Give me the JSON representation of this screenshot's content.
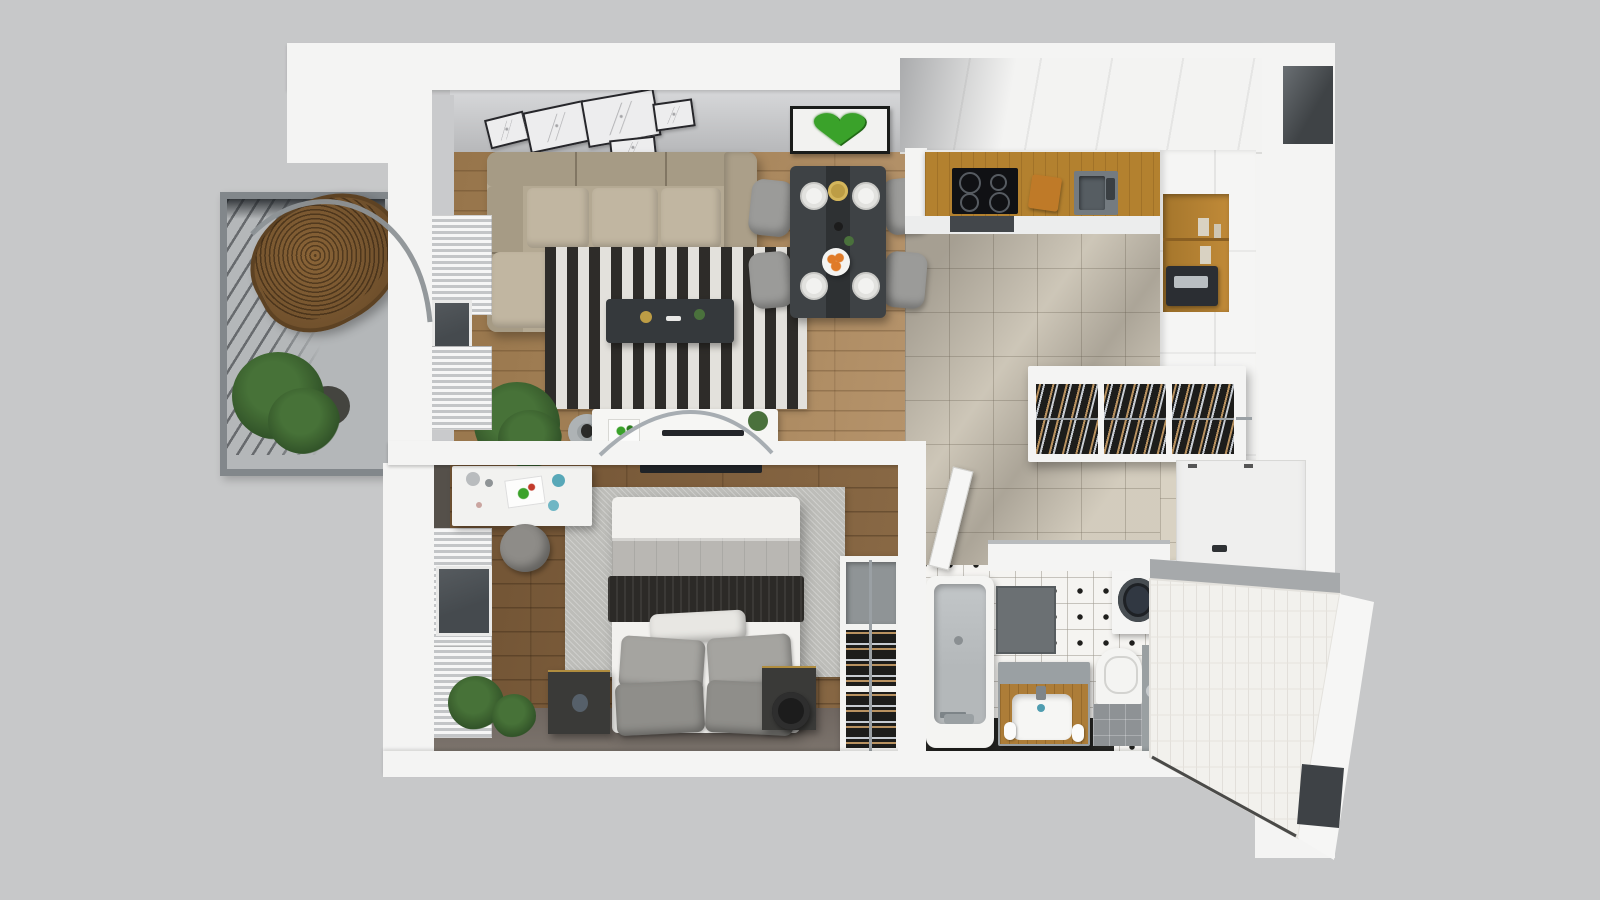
{
  "scene": {
    "label": "3D top-down floor plan render of a one-bedroom apartment"
  },
  "palette": {
    "bg": "#c7c8c9",
    "wall": "#f4f4f3",
    "innerface": "#c9cacc",
    "northface_top": "#d8d9db",
    "northface_bot": "#b7b8ba",
    "woodliving": "#a2805a",
    "woodbed": "#7a5a39",
    "tilekitchen": "#d9d2c3",
    "tilebath": "#f5f4f1",
    "balconyfloor": "#b4b7b9",
    "balframe": "#82878b",
    "rugdark": "#2e2c29",
    "ruglight": "#e3e1dc",
    "rugbed": "#bdbdb9",
    "sofa": "#b4a993",
    "sofaback": "#a69b85",
    "sofacushion": "#c1b6a1",
    "tabledark": "#3e4245",
    "chairgray": "#9b9b99",
    "counterwood": "#b3812f",
    "cooktop": "#101114",
    "sinkgray": "#747b80",
    "ovendark": "#43474b",
    "nichewood": "#b0813c",
    "machinedark": "#2b2e33",
    "shoedark": "#1d1d1b",
    "shoetan": "#b99260",
    "shoesilver": "#c7ccd2",
    "bedwhite": "#f2f1ee",
    "blanket": "#b9b7b3",
    "throw": "#2c2a27",
    "pillowa": "#8f8e8a",
    "pillowb": "#a5a4a0",
    "nightstand": "#3a3a38",
    "green": "#4a713c",
    "greendark": "#33522b",
    "heartgreen": "#3aa22a",
    "glass": "#454a4e",
    "ledge": "#a6a9ab",
    "doorwhite": "#efefee",
    "chrome": "#9aa1a5",
    "lamp": "#1c1c1c",
    "tubinner": "#b4b8ba",
    "orange": "#e07b28",
    "gold": "#bd9d45",
    "darkniche": "#3e4246",
    "floorshadowbed": "#6f6660",
    "chairbrown": "#7a5833"
  },
  "icons": {
    "heart_moss": "♥"
  },
  "rooms": {
    "living": {
      "label": "living room"
    },
    "dining": {
      "label": "dining area"
    },
    "kitchen": {
      "label": "kitchen"
    },
    "hall": {
      "label": "entry hall"
    },
    "bedroom": {
      "label": "bedroom"
    },
    "bathroom": {
      "label": "bathroom"
    },
    "balcony": {
      "label": "balcony"
    }
  },
  "furniture": {
    "sofa": {
      "label": "corner sofa"
    },
    "rug": {
      "label": "black and white striped rug"
    },
    "coffee_table": {
      "label": "coffee table"
    },
    "media_bench": {
      "label": "media bench"
    },
    "palm": {
      "label": "potted palm"
    },
    "gallery": {
      "label": "gallery wall frames"
    },
    "heart_art": {
      "label": "moss heart wall art"
    },
    "dining_table": {
      "label": "dining table set for four"
    },
    "dining_chair": {
      "label": "dining chair"
    },
    "counter": {
      "label": "kitchen counter"
    },
    "cooktop": {
      "label": "induction cooktop"
    },
    "sink": {
      "label": "kitchen sink"
    },
    "tall_cabinets": {
      "label": "tall kitchen cabinets"
    },
    "coffee_machine": {
      "label": "coffee machine niche"
    },
    "shoe_cabinet": {
      "label": "wall-hung shoe cabinet"
    },
    "entry_door": {
      "label": "entrance door"
    },
    "bed": {
      "label": "double bed"
    },
    "desk": {
      "label": "desk"
    },
    "desk_chair": {
      "label": "desk chair"
    },
    "nightstand": {
      "label": "nightstand"
    },
    "lamp": {
      "label": "bedside lamp"
    },
    "rack": {
      "label": "storage rack column"
    },
    "radiator": {
      "label": "wall radiator"
    },
    "balcony_door": {
      "label": "balcony door"
    },
    "window": {
      "label": "bedroom window"
    },
    "hanging_chair": {
      "label": "rattan hanging chair"
    },
    "balcony_plant": {
      "label": "balcony plant"
    },
    "bathtub": {
      "label": "bathtub"
    },
    "shower_mat": {
      "label": "shower tray"
    },
    "vanity": {
      "label": "wooden vanity with basin"
    },
    "toilet": {
      "label": "toilet"
    },
    "washing_machine": {
      "label": "washing machine"
    },
    "bath_door": {
      "label": "open bathroom door"
    },
    "tv": {
      "label": "wall TV"
    },
    "ledge": {
      "label": "tiled ledge wall"
    }
  }
}
